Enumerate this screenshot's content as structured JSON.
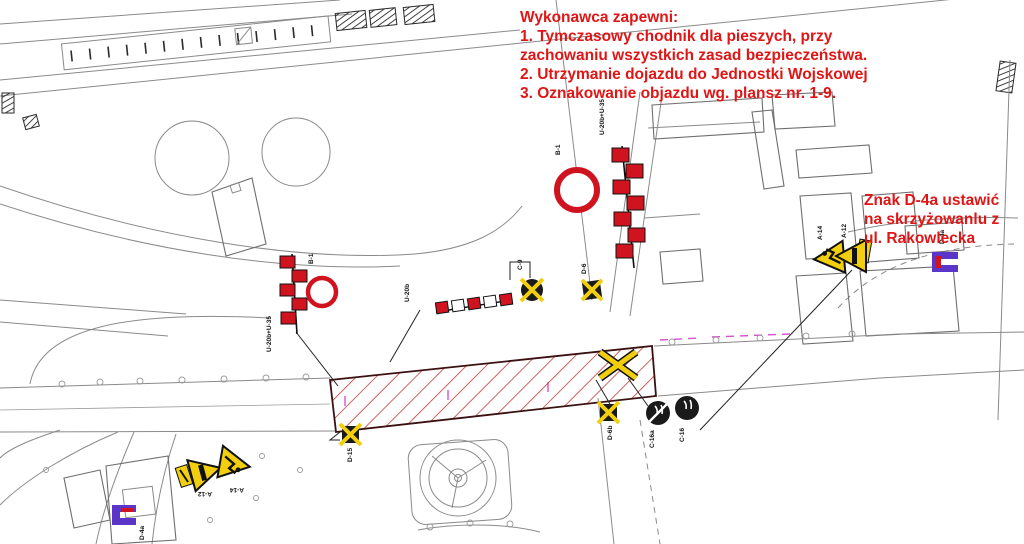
{
  "drawing": {
    "kind": "traffic-organization-site-plan",
    "colors": {
      "annotation_red": "#e01515",
      "barrier_red": "#cf1420",
      "hatch_red": "#c23b3b",
      "sign_yellow": "#f2cf0e",
      "sign_dark": "#1a1a1a",
      "sign_purple": "#5a35c8",
      "line_gray": "#8a8a8a",
      "magenta": "#d94fd0"
    }
  },
  "annotations": {
    "contractor_note": {
      "lines": [
        "Wykonawca zapewni:",
        "1. Tymczasowy chodnik dla pieszych, przy",
        "zachowaniu wszystkich zasad bezpieczeństwa.",
        "2. Utrzymanie dojazdu do Jednostki Wojskowej",
        "3. Oznakowanie objazdu wg. plansz nr. 1-9."
      ]
    },
    "d4a_note": {
      "lines": [
        "Znak D-4a ustawić",
        "na skrzyżowanlu z",
        "ul. Rakowlecka"
      ]
    }
  },
  "signs": {
    "barrier_left_label": "U-20b+U-35",
    "barrier_mid_label": "U-20b",
    "barrier_right_label": "U-20b+U-35",
    "b1_left": "B-1",
    "b1_right": "B-1",
    "c9": "C-9",
    "d6": "D-6",
    "d6b": "D-6b",
    "d15": "D-15",
    "c16a": "C-16a",
    "c16": "C-16",
    "a12_left": "A-12",
    "a14_left": "A-14",
    "a14_right": "A-14",
    "a12_right": "A-12",
    "d4a_left": "D-4a",
    "d4a_right": "D-4a"
  }
}
